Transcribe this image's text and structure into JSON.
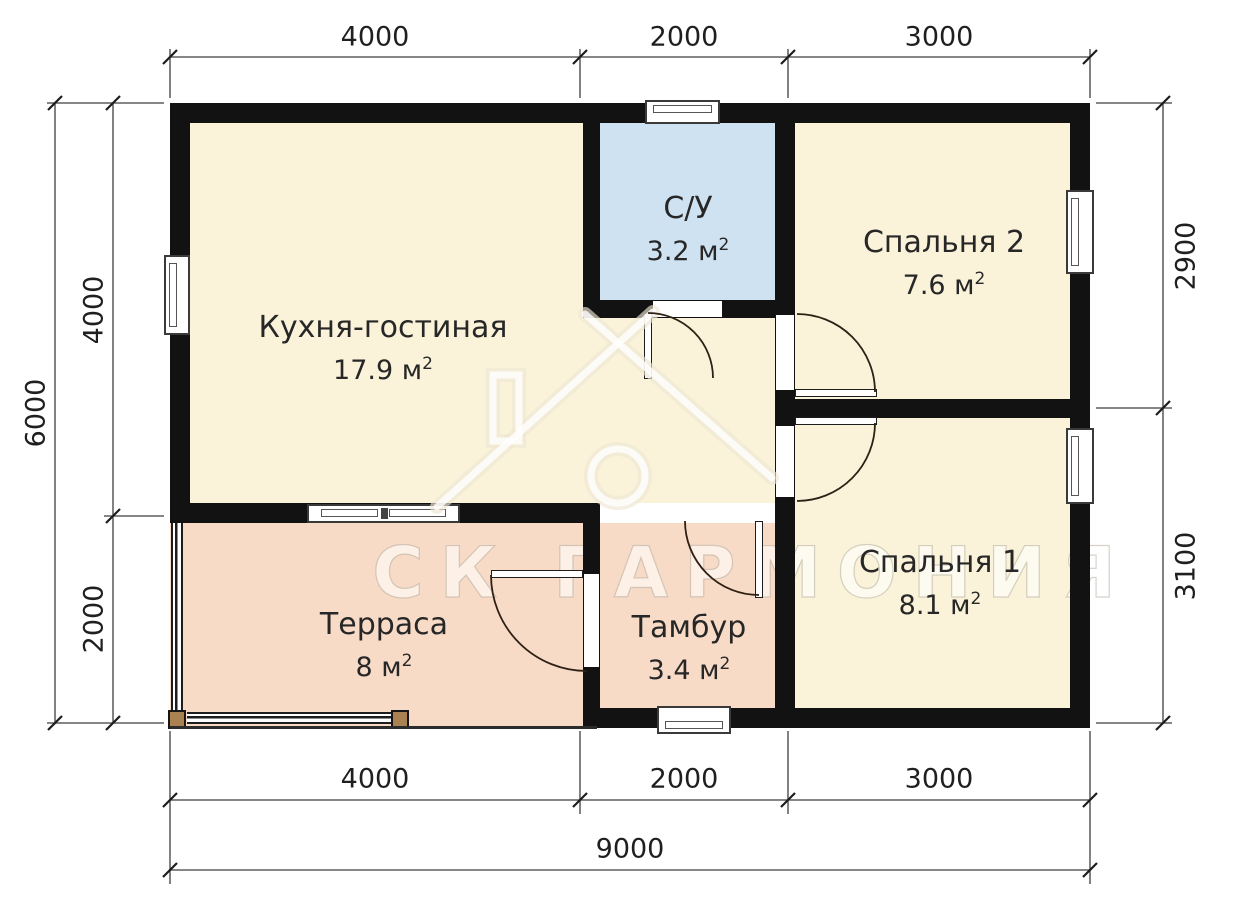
{
  "watermark": {
    "brand": "СК ГАРМОНИЯ"
  },
  "rooms": [
    {
      "id": "kitchen-living",
      "label": "Кухня-гостиная",
      "area": "17.9 м",
      "sup": "2"
    },
    {
      "id": "bathroom",
      "label": "С/У",
      "area": "3.2 м",
      "sup": "2"
    },
    {
      "id": "bedroom2",
      "label": "Спальня 2",
      "area": "7.6 м",
      "sup": "2"
    },
    {
      "id": "bedroom1",
      "label": "Спальня 1",
      "area": "8.1 м",
      "sup": "2"
    },
    {
      "id": "terrace",
      "label": "Терраса",
      "area": "8 м",
      "sup": "2"
    },
    {
      "id": "vestibule",
      "label": "Тамбур",
      "area": "3.4 м",
      "sup": "2"
    }
  ],
  "dimensions": {
    "top": [
      "4000",
      "2000",
      "3000"
    ],
    "bottom": [
      "4000",
      "2000",
      "3000"
    ],
    "bottom_total": "9000",
    "left": [
      "4000",
      "2000"
    ],
    "left_total": "6000",
    "right": [
      "2900",
      "3100"
    ]
  },
  "colors": {
    "room_cream": "#faf3da",
    "bathroom_blue": "#cfe2f2",
    "terrace_peach": "#f8dbc7",
    "wall": "#121212"
  }
}
